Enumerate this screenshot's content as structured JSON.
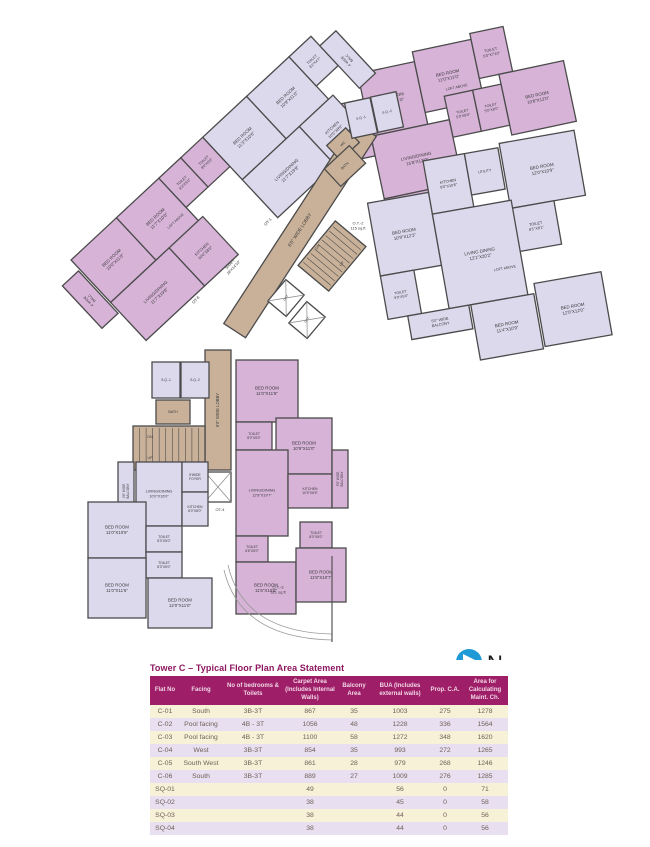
{
  "title": "Tower C – Typical Floor Plan Area Statement",
  "compass": {
    "label": "N"
  },
  "table": {
    "columns": [
      "Flat No",
      "Facing",
      "No of bedrooms & Toilets",
      "Carpet Area (Includes Internal Walls)",
      "Balcony Area",
      "BUA (Includes external walls)",
      "Prop. C.A.",
      "Area for Calculating Maint. Ch."
    ],
    "rows": [
      [
        "C-01",
        "South",
        "3B-3T",
        "867",
        "35",
        "1003",
        "275",
        "1278"
      ],
      [
        "C-02",
        "Pool facing",
        "4B - 3T",
        "1056",
        "48",
        "1228",
        "336",
        "1564"
      ],
      [
        "C-03",
        "Pool facing",
        "4B - 3T",
        "1100",
        "58",
        "1272",
        "348",
        "1620"
      ],
      [
        "C-04",
        "West",
        "3B-3T",
        "854",
        "35",
        "993",
        "272",
        "1265"
      ],
      [
        "C-05",
        "South West",
        "3B-3T",
        "861",
        "28",
        "979",
        "268",
        "1246"
      ],
      [
        "C-06",
        "South",
        "3B-3T",
        "889",
        "27",
        "1009",
        "276",
        "1285"
      ],
      [
        "SQ-01",
        "",
        "",
        "49",
        "",
        "56",
        "0",
        "71"
      ],
      [
        "SQ-02",
        "",
        "",
        "38",
        "",
        "45",
        "0",
        "58"
      ],
      [
        "SQ-03",
        "",
        "",
        "38",
        "",
        "44",
        "0",
        "56"
      ],
      [
        "SQ-04",
        "",
        "",
        "38",
        "",
        "44",
        "0",
        "56"
      ]
    ]
  },
  "plan": {
    "wall": "#4b4b4b",
    "ink": "#3b3b3b",
    "fills": {
      "pink": "#d7b3d8",
      "lav": "#dcd9ed",
      "tan": "#c9b199",
      "white": "#ffffff"
    },
    "groups": {
      "top": {
        "r": -12,
        "cx": 375,
        "cy": 160
      },
      "mid": {
        "r": -10,
        "cx": 390,
        "cy": 250
      },
      "diag": {
        "r": -43,
        "cx": 150,
        "cy": 330
      }
    },
    "rooms": [
      {
        "id": "balcony",
        "g": "top",
        "x": 354,
        "y": 98,
        "w": 22,
        "h": 58,
        "f": "pink",
        "l": [
          "4' WIDE",
          "BALC"
        ],
        "lr": -90,
        "fs": 3.8
      },
      {
        "id": "bed-room",
        "g": "top",
        "x": 376,
        "y": 72,
        "w": 58,
        "h": 64,
        "f": "pink",
        "l": [
          "BED ROOM",
          "10'0\"X11'0\""
        ]
      },
      {
        "id": "bed-room",
        "g": "top",
        "x": 434,
        "y": 62,
        "w": 60,
        "h": 62,
        "f": "pink",
        "l": [
          "BED ROOM",
          "11'0\"X11'0\""
        ]
      },
      {
        "id": "toilet",
        "g": "top",
        "x": 494,
        "y": 56,
        "w": 34,
        "h": 46,
        "f": "pink",
        "l": [
          "TOILET",
          "5'0\"X7'10\""
        ],
        "fs": 3.8
      },
      {
        "id": "bed-room",
        "g": "top",
        "x": 514,
        "y": 102,
        "w": 66,
        "h": 62,
        "f": "pink",
        "l": [
          "BED ROOM",
          "10'8\"X12'0\""
        ]
      },
      {
        "id": "toilet",
        "g": "top",
        "x": 456,
        "y": 112,
        "w": 29,
        "h": 42,
        "f": "pink",
        "l": [
          "TOILET",
          "5'0\"X8'0\""
        ],
        "fs": 3.6
      },
      {
        "id": "toilet",
        "g": "top",
        "x": 485,
        "y": 112,
        "w": 29,
        "h": 42,
        "f": "pink",
        "l": [
          "TOILET",
          "5'0\"X8'0\""
        ],
        "fs": 3.6
      },
      {
        "id": "living-dining",
        "g": "top",
        "x": 376,
        "y": 136,
        "w": 80,
        "h": 64,
        "f": "pink",
        "l": [
          "LIVING/DINING",
          "15'8\"X12'0\""
        ]
      },
      {
        "id": "kitchen",
        "g": "top",
        "x": 376,
        "y": 200,
        "w": 58,
        "h": 40,
        "f": "pink",
        "l": [
          "KITCHEN",
          "10'0\"X8'0\""
        ],
        "fs": 4
      },
      {
        "id": "bed-room",
        "g": "mid",
        "x": 376,
        "y": 200,
        "w": 62,
        "h": 74,
        "f": "lav",
        "l": [
          "BED ROOM",
          "10'9\"X12'3\""
        ]
      },
      {
        "id": "toilet",
        "g": "mid",
        "x": 376,
        "y": 274,
        "w": 34,
        "h": 44,
        "f": "lav",
        "l": [
          "TOILET",
          "9'0\"X5'0\""
        ],
        "fs": 3.6
      },
      {
        "id": "kitchen",
        "g": "mid",
        "x": 438,
        "y": 168,
        "w": 42,
        "h": 54,
        "f": "lav",
        "l": [
          "KITCHEN",
          "8'0\"X10'6\""
        ],
        "fs": 3.8
      },
      {
        "id": "utility",
        "g": "mid",
        "x": 480,
        "y": 168,
        "w": 34,
        "h": 42,
        "f": "lav",
        "l": [
          "UTILITY"
        ],
        "fs": 3.6
      },
      {
        "id": "bed-room",
        "g": "mid",
        "x": 516,
        "y": 164,
        "w": 76,
        "h": 66,
        "f": "lav",
        "l": [
          "BED ROOM",
          "12'0\"X10'9\""
        ]
      },
      {
        "id": "toilet",
        "g": "mid",
        "x": 516,
        "y": 230,
        "w": 44,
        "h": 44,
        "f": "lav",
        "l": [
          "TOILET",
          "8'1\"X8'1\""
        ],
        "fs": 3.8
      },
      {
        "id": "living-dining",
        "g": "mid",
        "x": 438,
        "y": 222,
        "w": 80,
        "h": 96,
        "f": "lav",
        "l": [
          "LIVING DINING",
          "12'1\"X20'2\""
        ]
      },
      {
        "id": "bed-room",
        "g": "mid",
        "x": 460,
        "y": 318,
        "w": 64,
        "h": 56,
        "f": "lav",
        "l": [
          "BED ROOM",
          "11'4\"X10'9\""
        ]
      },
      {
        "id": "bed-room",
        "g": "mid",
        "x": 526,
        "y": 308,
        "w": 68,
        "h": 64,
        "f": "lav",
        "l": [
          "BED ROOM",
          "12'0\"X12'0\""
        ]
      },
      {
        "id": "balcony",
        "g": "mid",
        "x": 396,
        "y": 318,
        "w": 62,
        "h": 24,
        "f": "lav",
        "l": [
          "5'0\" WIDE",
          "BALCONY"
        ],
        "fs": 3.8
      },
      {
        "id": "balcony",
        "g": "diag",
        "x": 116,
        "y": 238,
        "w": 22,
        "h": 58,
        "f": "pink",
        "l": [
          "4' WIDE",
          "BALC"
        ],
        "lr": -90,
        "fs": 3.6
      },
      {
        "id": "bed-room",
        "g": "diag",
        "x": 140,
        "y": 225,
        "w": 62,
        "h": 58,
        "f": "pink",
        "l": [
          "BED ROOM",
          "10'0\"X11'0\""
        ]
      },
      {
        "id": "bed-room",
        "g": "diag",
        "x": 202,
        "y": 225,
        "w": 58,
        "h": 58,
        "f": "pink",
        "l": [
          "BED ROOM",
          "11'7\"X10'0\""
        ]
      },
      {
        "id": "toilet",
        "g": "diag",
        "x": 260,
        "y": 225,
        "w": 30,
        "h": 40,
        "f": "pink",
        "l": [
          "TOILET",
          "8'3\"X5'0\""
        ],
        "fs": 3.6
      },
      {
        "id": "toilet",
        "g": "diag",
        "x": 290,
        "y": 225,
        "w": 30,
        "h": 40,
        "f": "pink",
        "l": [
          "TOILET",
          "8'0\"X5'0\""
        ],
        "fs": 3.6
      },
      {
        "id": "living-dining",
        "g": "diag",
        "x": 140,
        "y": 283,
        "w": 80,
        "h": 52,
        "f": "pink",
        "l": [
          "LIVING/DINING",
          "11'7\"X19'8\""
        ]
      },
      {
        "id": "kitchen",
        "g": "diag",
        "x": 220,
        "y": 283,
        "w": 46,
        "h": 52,
        "f": "pink",
        "l": [
          "KITCHEN",
          "10'0\"X8'0\""
        ],
        "fs": 4
      },
      {
        "id": "bed-room",
        "g": "diag",
        "x": 320,
        "y": 225,
        "w": 60,
        "h": 58,
        "f": "lav",
        "l": [
          "BED ROOM",
          "11'3\"X10'6\""
        ]
      },
      {
        "id": "bed-room",
        "g": "diag",
        "x": 380,
        "y": 225,
        "w": 58,
        "h": 58,
        "f": "lav",
        "l": [
          "BED ROOM",
          "10'9\"X11'0\""
        ]
      },
      {
        "id": "toilet",
        "g": "diag",
        "x": 438,
        "y": 225,
        "w": 30,
        "h": 40,
        "f": "lav",
        "l": [
          "TOILET",
          "8'2\"X4'7\""
        ],
        "fs": 3.6
      },
      {
        "id": "living-dining",
        "g": "diag",
        "x": 320,
        "y": 283,
        "w": 78,
        "h": 52,
        "f": "lav",
        "l": [
          "LIVING/DINING",
          "11'7\"X19'8\""
        ]
      },
      {
        "id": "kitchen",
        "g": "diag",
        "x": 398,
        "y": 283,
        "w": 46,
        "h": 52,
        "f": "lav",
        "l": [
          "KITCHEN",
          "10'0\"X8'0\""
        ],
        "fs": 4
      },
      {
        "id": "balcony",
        "g": "diag",
        "x": 468,
        "y": 238,
        "w": 22,
        "h": 58,
        "f": "lav",
        "l": [
          "4' WIDE",
          "BALC"
        ],
        "lr": -90,
        "fs": 3.6
      },
      {
        "id": "lobby",
        "x": 180,
        "y": 217,
        "w": 240,
        "h": 26,
        "f": "tan",
        "rot": -57,
        "l": [
          "6'0\" WIDE LOBBY"
        ],
        "fs": 4.8
      },
      {
        "id": "wc",
        "x": 330,
        "y": 134,
        "w": 26,
        "h": 20,
        "f": "tan",
        "rot": -43,
        "l": [
          "WC"
        ],
        "fs": 3.6
      },
      {
        "id": "bath",
        "x": 328,
        "y": 154,
        "w": 34,
        "h": 24,
        "f": "tan",
        "rot": -43,
        "l": [
          "BATH"
        ],
        "fs": 3.6
      },
      {
        "id": "servant-quarter",
        "x": 348,
        "y": 100,
        "w": 26,
        "h": 36,
        "f": "lav",
        "rot": -12,
        "l": [
          "S.Q.-1"
        ],
        "fs": 3.4
      },
      {
        "id": "servant-quarter",
        "x": 374,
        "y": 94,
        "w": 26,
        "h": 36,
        "f": "lav",
        "rot": -12,
        "l": [
          "S.Q.-2"
        ],
        "fs": 3.4
      },
      {
        "id": "staircase",
        "x": 303,
        "y": 236,
        "w": 58,
        "h": 40,
        "f": "tan",
        "rot": -50,
        "stair": 9
      },
      {
        "id": "lift",
        "x": 272,
        "y": 286,
        "w": 28,
        "h": 24,
        "f": "white",
        "rot": -50,
        "cross": true,
        "l": [
          "LIFT"
        ],
        "fs": 3.2
      },
      {
        "id": "lift",
        "x": 293,
        "y": 308,
        "w": 28,
        "h": 24,
        "f": "white",
        "rot": -50,
        "cross": true,
        "l": [
          "LIFT"
        ],
        "fs": 3.2
      },
      {
        "id": "lobby",
        "x": 205,
        "y": 350,
        "w": 26,
        "h": 120,
        "f": "tan",
        "l": [
          "6'0\" WIDE LOBBY"
        ],
        "lr": -90,
        "fs": 4.2
      },
      {
        "id": "servant-quarter",
        "x": 152,
        "y": 362,
        "w": 28,
        "h": 36,
        "f": "lav",
        "l": [
          "S.Q.-1"
        ],
        "fs": 3.4
      },
      {
        "id": "servant-quarter",
        "x": 181,
        "y": 362,
        "w": 28,
        "h": 36,
        "f": "lav",
        "l": [
          "S.Q.-2"
        ],
        "fs": 3.4
      },
      {
        "id": "bath",
        "x": 156,
        "y": 400,
        "w": 34,
        "h": 24,
        "f": "tan",
        "l": [
          "BATH"
        ],
        "fs": 3.6
      },
      {
        "id": "staircase",
        "x": 133,
        "y": 426,
        "w": 72,
        "h": 44,
        "f": "tan",
        "stair": 10
      },
      {
        "id": "shaft",
        "x": 205,
        "y": 472,
        "w": 26,
        "h": 30,
        "f": "white",
        "cross": true
      },
      {
        "id": "balcony",
        "x": 118,
        "y": 462,
        "w": 16,
        "h": 58,
        "f": "lav",
        "l": [
          "4'6\" WIDE",
          "BALCONY"
        ],
        "lr": -90,
        "fs": 3.2
      },
      {
        "id": "living-dining",
        "x": 136,
        "y": 462,
        "w": 46,
        "h": 64,
        "f": "lav",
        "l": [
          "LIVING/DINING",
          "10'0\"X16'0\""
        ],
        "fs": 3.8
      },
      {
        "id": "foyer",
        "x": 182,
        "y": 462,
        "w": 26,
        "h": 30,
        "f": "lav",
        "l": [
          "5'WIDE",
          "FOYER"
        ],
        "fs": 3.4
      },
      {
        "id": "kitchen",
        "x": 182,
        "y": 492,
        "w": 26,
        "h": 34,
        "f": "lav",
        "l": [
          "KITCHEN",
          "8'0\"X8'0\""
        ],
        "fs": 3.4
      },
      {
        "id": "bed-room",
        "x": 88,
        "y": 502,
        "w": 58,
        "h": 56,
        "f": "lav",
        "l": [
          "BED ROOM",
          "11'0\"X10'6\""
        ]
      },
      {
        "id": "toilet",
        "x": 146,
        "y": 526,
        "w": 36,
        "h": 26,
        "f": "lav",
        "l": [
          "TOILET",
          "8'3\"X5'0\""
        ],
        "fs": 3.4
      },
      {
        "id": "toilet",
        "x": 146,
        "y": 552,
        "w": 36,
        "h": 26,
        "f": "lav",
        "l": [
          "TOILET",
          "8'3\"X5'0\""
        ],
        "fs": 3.4
      },
      {
        "id": "bed-room",
        "x": 88,
        "y": 558,
        "w": 58,
        "h": 60,
        "f": "lav",
        "l": [
          "BED ROOM",
          "11'0\"X11'6\""
        ]
      },
      {
        "id": "bed-room",
        "x": 148,
        "y": 578,
        "w": 64,
        "h": 50,
        "f": "lav",
        "l": [
          "BED ROOM",
          "12'0\"X11'0\""
        ]
      },
      {
        "id": "bed-room",
        "x": 236,
        "y": 360,
        "w": 62,
        "h": 62,
        "f": "pink",
        "l": [
          "BED ROOM",
          "11'0\"X11'9\""
        ]
      },
      {
        "id": "toilet",
        "x": 236,
        "y": 422,
        "w": 36,
        "h": 28,
        "f": "pink",
        "l": [
          "TOILET",
          "8'0\"X5'0\""
        ],
        "fs": 3.4
      },
      {
        "id": "bed-room",
        "x": 276,
        "y": 418,
        "w": 56,
        "h": 56,
        "f": "pink",
        "l": [
          "BED ROOM",
          "10'9\"X11'0\""
        ]
      },
      {
        "id": "living-dining",
        "x": 236,
        "y": 450,
        "w": 52,
        "h": 86,
        "f": "pink",
        "l": [
          "LIVING/DINING",
          "12'8\"X19'7\""
        ],
        "fs": 3.8
      },
      {
        "id": "kitchen",
        "x": 288,
        "y": 474,
        "w": 44,
        "h": 34,
        "f": "pink",
        "l": [
          "KITCHEN",
          "10'9\"X6'5\""
        ],
        "fs": 3.4
      },
      {
        "id": "balcony",
        "x": 332,
        "y": 450,
        "w": 16,
        "h": 58,
        "f": "pink",
        "l": [
          "5'0\" WIDE",
          "BALCONY"
        ],
        "lr": -90,
        "fs": 3.2
      },
      {
        "id": "toilet",
        "x": 236,
        "y": 536,
        "w": 32,
        "h": 26,
        "f": "pink",
        "l": [
          "TOILET",
          "6'6\"X5'0\""
        ],
        "fs": 3.4
      },
      {
        "id": "toilet",
        "x": 300,
        "y": 522,
        "w": 32,
        "h": 26,
        "f": "pink",
        "l": [
          "TOILET",
          "8'0\"X5'0\""
        ],
        "fs": 3.4
      },
      {
        "id": "bed-room",
        "x": 236,
        "y": 562,
        "w": 60,
        "h": 52,
        "f": "pink",
        "l": [
          "BED ROOM",
          "11'5\"X10'8\""
        ]
      },
      {
        "id": "bed-room",
        "x": 296,
        "y": 548,
        "w": 50,
        "h": 54,
        "f": "pink",
        "l": [
          "BED ROOM",
          "11'8\"X10'7\""
        ]
      }
    ],
    "labels": [
      {
        "g": "top",
        "x": 470,
        "y": 106,
        "l": [
          "LOFT ABOVE"
        ],
        "fs": 3.6
      },
      {
        "g": "mid",
        "x": 500,
        "y": 288,
        "l": [
          "LOFT ABOVE"
        ],
        "fs": 3.6
      },
      {
        "g": "diag",
        "x": 243,
        "y": 268,
        "l": [
          "LOFT ABOVE"
        ],
        "fs": 3.4
      },
      {
        "x": 358,
        "y": 226,
        "l": [
          "O.T.-2",
          "115 sq.ft"
        ],
        "fs": 4
      },
      {
        "x": 278,
        "y": 590,
        "l": [
          "O.T.-3",
          "321 sq.ft"
        ],
        "fs": 4
      },
      {
        "x": 268,
        "y": 222,
        "l": [
          "OT-1"
        ],
        "rot": -47,
        "fs": 4
      },
      {
        "x": 196,
        "y": 300,
        "l": [
          "OT-6"
        ],
        "rot": -47,
        "fs": 4
      },
      {
        "x": 232,
        "y": 266,
        "l": [
          "SHAFT",
          "28'X14'10\""
        ],
        "rot": -47,
        "fs": 3.8
      },
      {
        "x": 220,
        "y": 510,
        "l": [
          "OT-4"
        ],
        "fs": 4
      },
      {
        "x": 318,
        "y": 247,
        "l": [
          "DN"
        ],
        "rot": -50,
        "fs": 3.6
      },
      {
        "x": 342,
        "y": 264,
        "l": [
          "UP"
        ],
        "rot": -50,
        "fs": 3.6
      },
      {
        "x": 150,
        "y": 437,
        "l": [
          "DN"
        ],
        "fs": 3.6
      },
      {
        "x": 150,
        "y": 458,
        "l": [
          "UP"
        ],
        "fs": 3.6
      }
    ],
    "paths": [
      {
        "d": "M224,570 Q240,638 332,640",
        "c": "#9a9a9a",
        "w": 0.8
      },
      {
        "d": "M228,565 Q243,632 332,634",
        "c": "#9a9a9a",
        "w": 0.8
      },
      {
        "d": "M332,556 L332,642",
        "c": "#555555",
        "w": 1.2
      }
    ],
    "compass_color": "#1f9ad6"
  }
}
